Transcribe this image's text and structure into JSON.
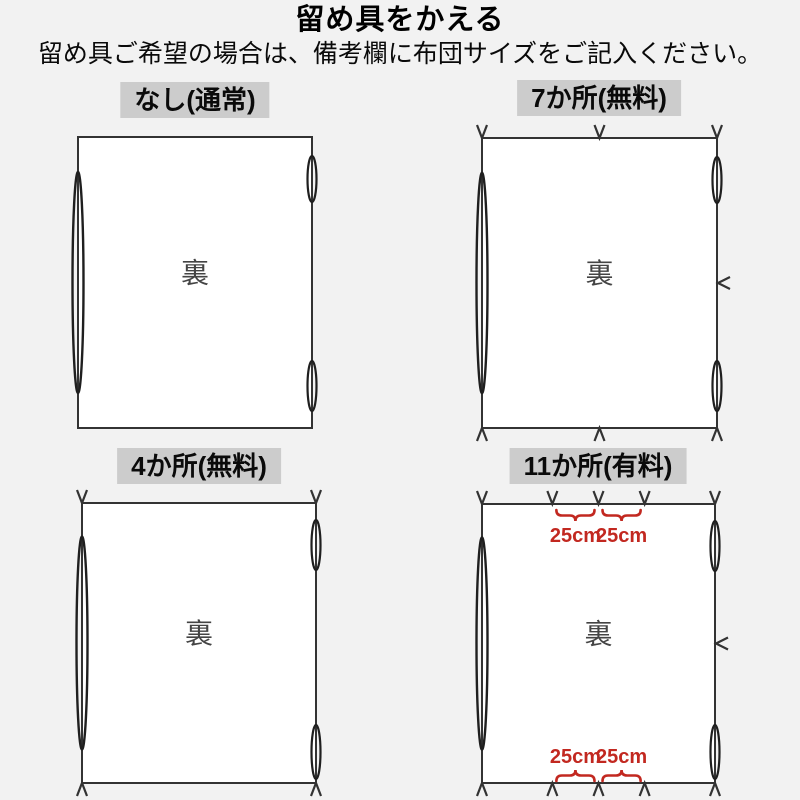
{
  "page": {
    "title": "留め具をかえる",
    "subtitle": "留め具ご希望の場合は、備考欄に布団サイズをご記入ください。"
  },
  "colors": {
    "background": "#f2f2f2",
    "panel_fill": "#ffffff",
    "line": "#333333",
    "loop_line": "#1f1f1f",
    "label_bg": "#cccccc",
    "back_text": "#444444",
    "accent_red": "#c22820"
  },
  "diagrams": [
    {
      "label": "なし(通常)",
      "center_text": "裏",
      "marks": {
        "top": [],
        "bottom": [],
        "right": []
      }
    },
    {
      "label": "7か所(無料)",
      "center_text": "裏",
      "marks": {
        "top": [
          0,
          0.5,
          1
        ],
        "bottom": [
          0,
          0.5,
          1
        ],
        "right": [
          0.5
        ]
      }
    },
    {
      "label": "4か所(無料)",
      "center_text": "裏",
      "marks": {
        "top": [
          0,
          1
        ],
        "bottom": [
          0,
          1
        ],
        "right": []
      }
    },
    {
      "label": "11か所(有料)",
      "center_text": "裏",
      "marks": {
        "top": [
          0,
          0.302,
          0.5,
          0.698,
          1
        ],
        "bottom": [
          0,
          0.302,
          0.5,
          0.698,
          1
        ],
        "right": [
          0.5
        ]
      },
      "dimensions": {
        "top": [
          {
            "between": [
              1,
              2
            ],
            "label": "25cm"
          },
          {
            "between": [
              2,
              3
            ],
            "label": "25cm"
          }
        ],
        "bottom": [
          {
            "between": [
              1,
              2
            ],
            "label": "25cm"
          },
          {
            "between": [
              2,
              3
            ],
            "label": "25cm"
          }
        ]
      }
    }
  ]
}
